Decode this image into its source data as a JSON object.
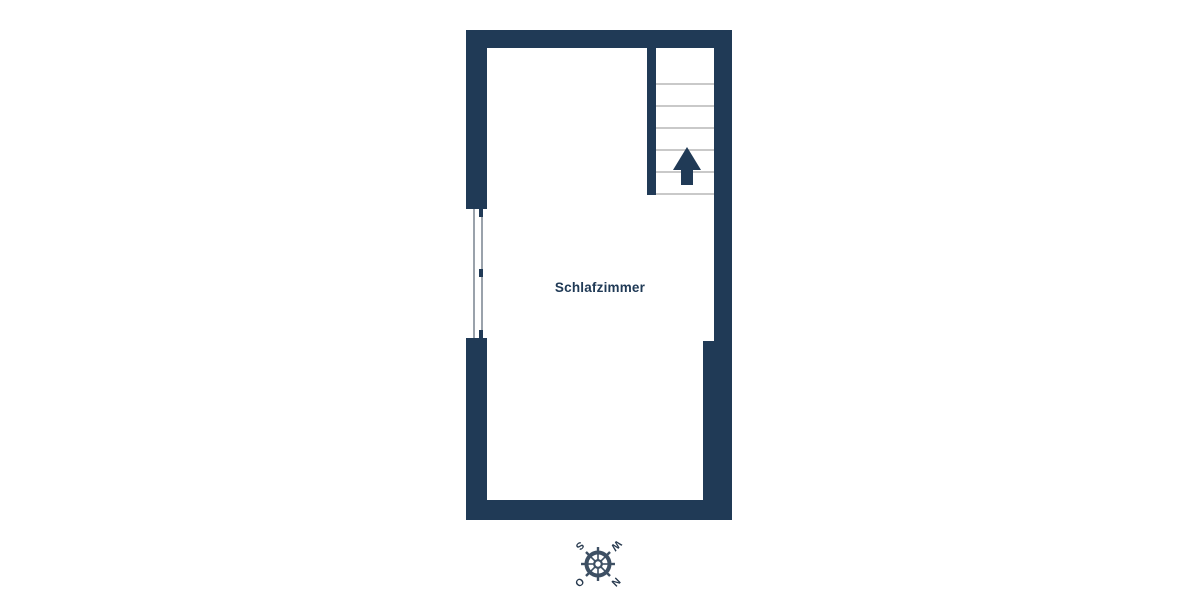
{
  "floorplan": {
    "room": {
      "label": "Schlafzimmer"
    },
    "stairs": {
      "tread_count": 6,
      "tread_spacing_px": 22,
      "first_tread_offset_px": 35,
      "direction": "up"
    },
    "window": {
      "side": "left",
      "mullion_count": 3
    },
    "compass": {
      "rotation_deg": 135,
      "letters": {
        "north": "N",
        "east": "O",
        "south": "S",
        "west": "W"
      }
    },
    "colors": {
      "background": "#ffffff",
      "wall": "#203a56",
      "stair_tread": "#c9c9c9",
      "window_line": "#9aa2ab",
      "compass_wheel": "#3d4f63",
      "compass_letter": "#27394e"
    }
  }
}
